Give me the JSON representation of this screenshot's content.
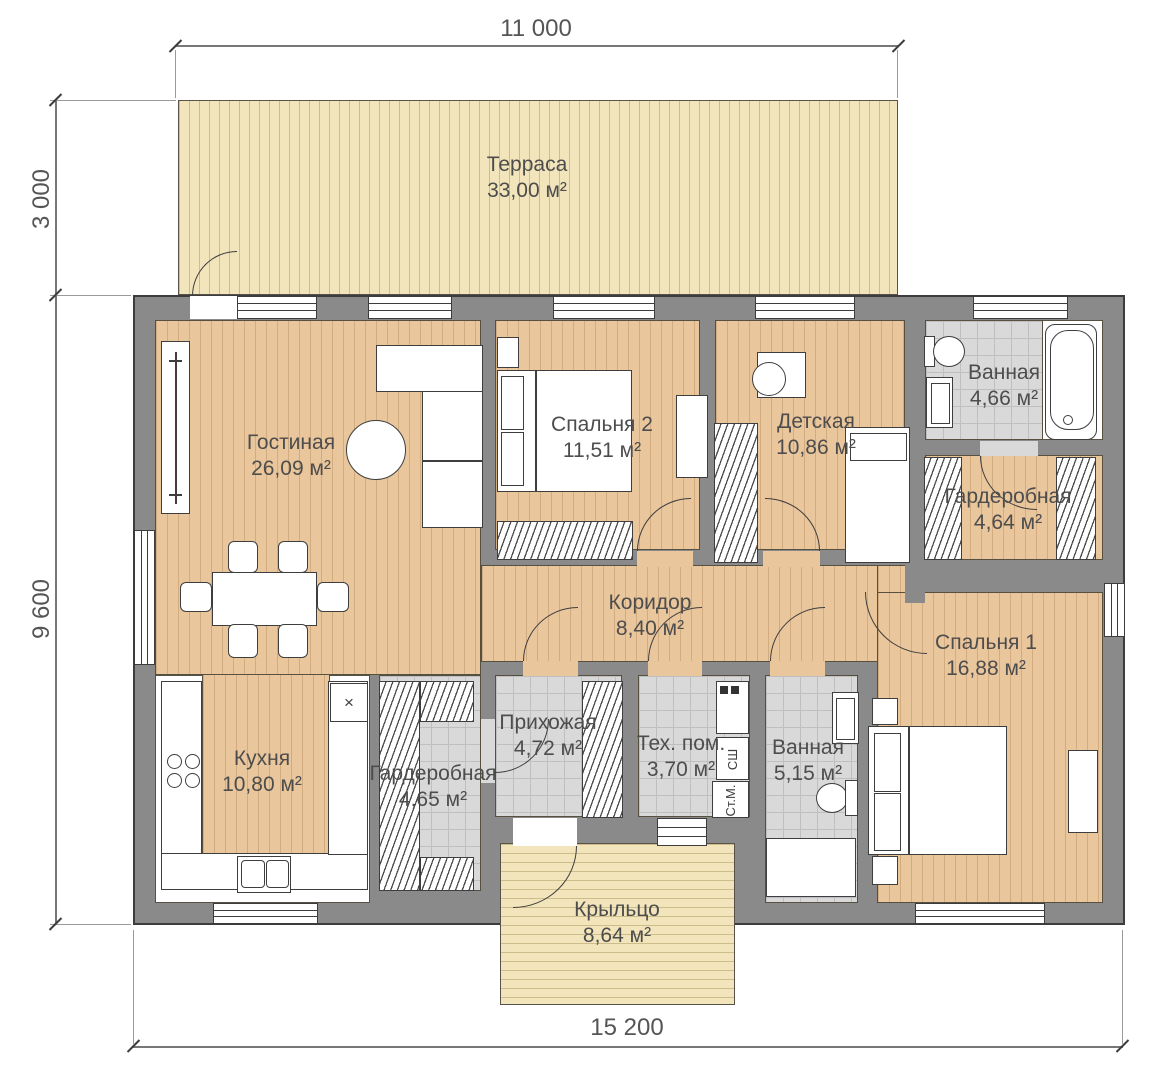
{
  "dimensions": {
    "top": "11 000",
    "left_upper": "3 000",
    "left_lower": "9 600",
    "bottom": "15 200"
  },
  "rooms": {
    "terrace": {
      "name": "Терраса",
      "area": "33,00 м²"
    },
    "living": {
      "name": "Гостиная",
      "area": "26,09 м²"
    },
    "bedroom2": {
      "name": "Спальня 2",
      "area": "11,51 м²"
    },
    "kids": {
      "name": "Детская",
      "area": "10,86 м²"
    },
    "bath1": {
      "name": "Ванная",
      "area": "4,66 м²"
    },
    "wardrobe1": {
      "name": "Гардеробная",
      "area": "4,64 м²"
    },
    "corridor": {
      "name": "Коридор",
      "area": "8,40 м²"
    },
    "bedroom1": {
      "name": "Спальня 1",
      "area": "16,88 м²"
    },
    "kitchen": {
      "name": "Кухня",
      "area": "10,80 м²"
    },
    "wardrobe2": {
      "name": "Гардеробная",
      "area": "4,65 м²"
    },
    "hall": {
      "name": "Прихожая",
      "area": "4,72 м²"
    },
    "tech": {
      "name": "Тех. пом.",
      "area": "3,70 м²"
    },
    "bath2": {
      "name": "Ванная",
      "area": "5,15 м²"
    },
    "porch": {
      "name": "Крыльцо",
      "area": "8,64 м²"
    }
  },
  "tech_room": {
    "dryer_label": "СШ",
    "washer_label": "Ст.М."
  },
  "kitchen_fixtures": {
    "corner_cabinet_symbol": "×"
  },
  "colors": {
    "wall": "#8a8a8a",
    "wood_floor": "#eac69c",
    "terrace_deck": "#f3e5bb",
    "tile_floor": "#d9d9d9",
    "outline": "#3c3c3c",
    "text": "#4d4d4d"
  }
}
